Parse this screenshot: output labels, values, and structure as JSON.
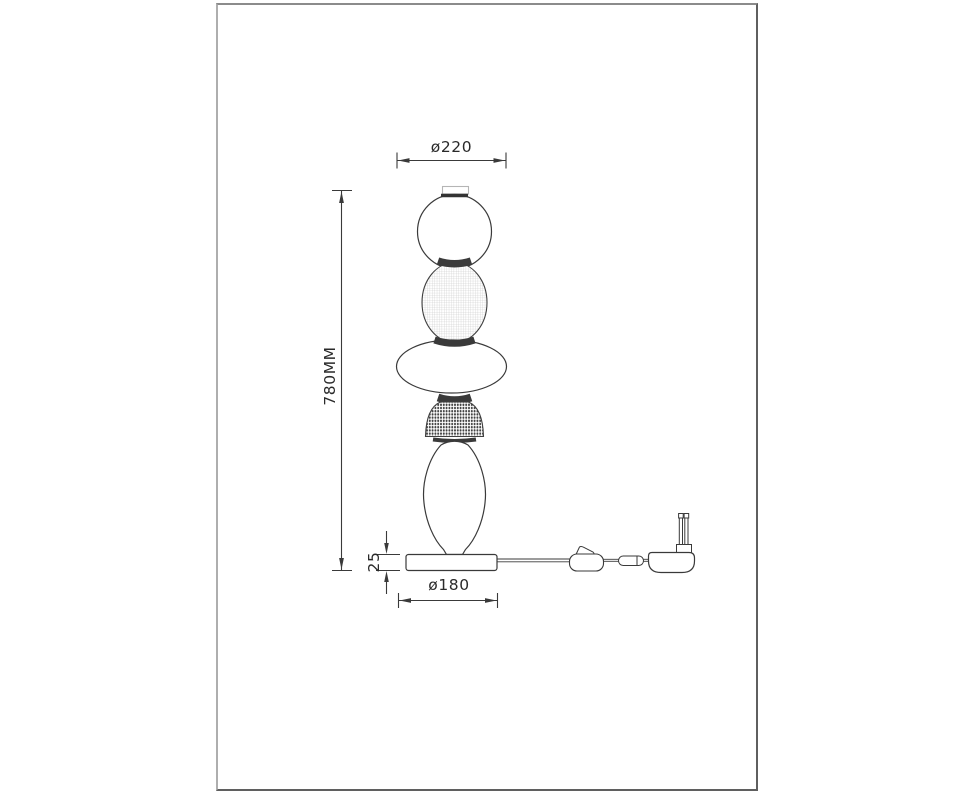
{
  "page": {
    "background": "#ffffff",
    "frame_color": "#8b8b8b",
    "line_color": "#3a3a3a",
    "grid_texture_color": "#c6c6c6",
    "dot_texture_color": "#424242",
    "label_color": "#2a2a2a"
  },
  "drawing": {
    "type": "lamp-dimension-drawing",
    "labels": {
      "top_diameter": "ø220",
      "overall_height": "780MM",
      "base_thickness": "25",
      "base_diameter": "ø180"
    },
    "parts": [
      "top-cap",
      "sphere-glass-shade",
      "textured-barrel-shade",
      "ellipse-disc-shade",
      "textured-dome-shade",
      "egg-glass-shade",
      "round-base",
      "power-cord",
      "inline-switch",
      "cord-connector",
      "power-plug"
    ]
  }
}
